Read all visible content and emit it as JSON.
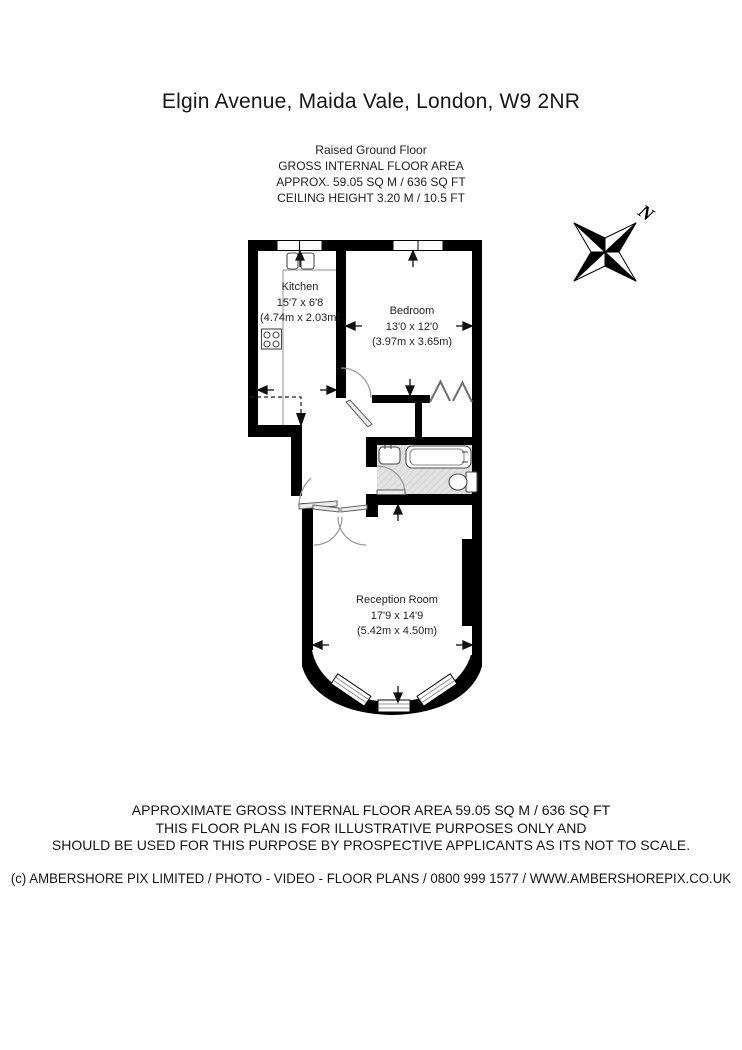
{
  "page": {
    "title": "Elgin Avenue, Maida Vale, London, W9 2NR"
  },
  "header": {
    "floor_name": "Raised Ground Floor",
    "area_label": "GROSS INTERNAL FLOOR AREA",
    "area_value": "APPROX. 59.05 SQ M / 636 SQ FT",
    "ceiling_height": "CEILING HEIGHT 3.20 M / 10.5 FT"
  },
  "rooms": {
    "kitchen": {
      "name": "Kitchen",
      "size_imperial": "15'7 x 6'8",
      "size_metric": "(4.74m x 2.03m)"
    },
    "bedroom": {
      "name": "Bedroom",
      "size_imperial": "13'0 x 12'0",
      "size_metric": "(3.97m x 3.65m)"
    },
    "reception": {
      "name": "Reception Room",
      "size_imperial": "17'9 x 14'9",
      "size_metric": "(5.42m x 4.50m)"
    }
  },
  "compass": {
    "north_label": "N"
  },
  "disclaimer": {
    "line1": "APPROXIMATE GROSS INTERNAL FLOOR AREA 59.05 SQ M / 636 SQ FT",
    "line2": "THIS FLOOR PLAN IS FOR ILLUSTRATIVE PURPOSES ONLY AND",
    "line3": "SHOULD BE USED FOR THIS PURPOSE BY PROSPECTIVE APPLICANTS AS ITS NOT TO SCALE."
  },
  "copyright": "(c) AMBERSHORE PIX LIMITED / PHOTO - VIDEO - FLOOR PLANS / 0800 999 1577 / WWW.AMBERSHOREPIX.CO.UK",
  "colors": {
    "wall": "#000000",
    "bathroom_floor": "#e2e2e2",
    "text": "#1d1d1d"
  }
}
